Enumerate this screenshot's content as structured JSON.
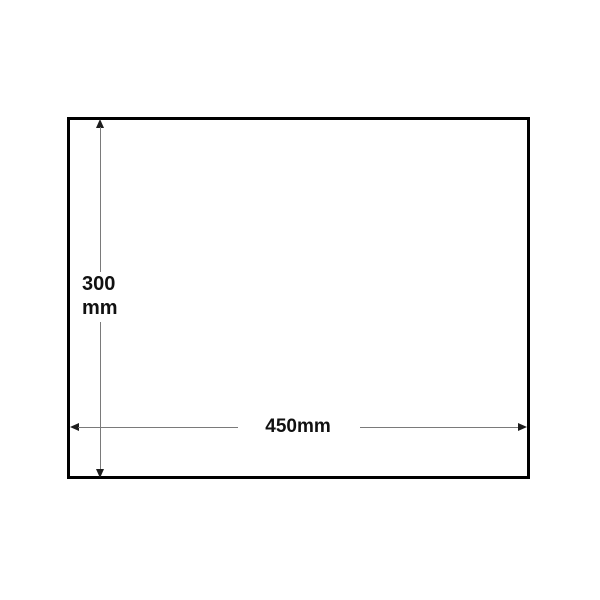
{
  "colors": {
    "canvas-bg": "#ffffff",
    "rect-border": "#000000",
    "dim-line": "#7a7a7a",
    "arrow": "#1c1c1c",
    "dim-text": "#111111"
  },
  "diagram": {
    "height_dimension": {
      "value_line1": "300",
      "value_line2": "mm"
    },
    "width_dimension": {
      "value": "450mm"
    }
  }
}
